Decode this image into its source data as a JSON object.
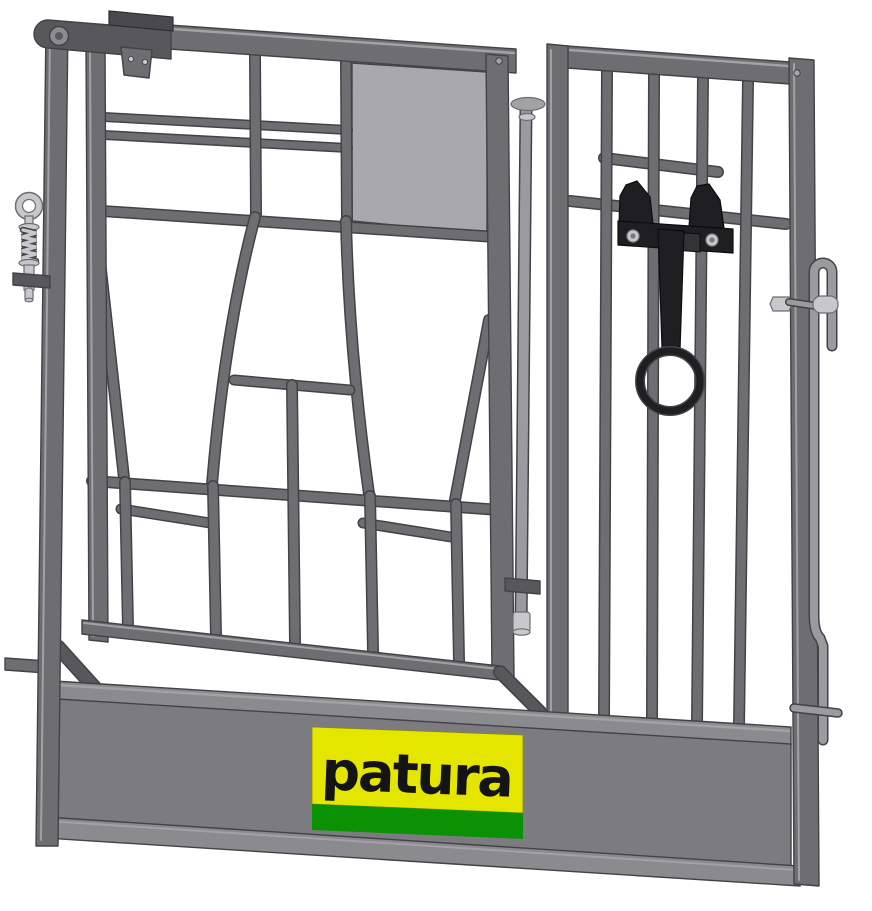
{
  "logo": {
    "text": "patura",
    "panel_bg": "#e5e600",
    "stripe": "#0a9104",
    "text_color": "#141414"
  },
  "colors": {
    "bg": "#ffffff",
    "steel": "#6e6e72",
    "steel_edge": "#434347",
    "steel_light": "#a2a2a6",
    "steel_dark": "#58585c",
    "sheet": "#a9a9ac",
    "trough": "#7c7c80",
    "trough_rail": "#8b8b8f",
    "black_part": "#1f1f22",
    "black_edge": "#0c0c0e",
    "silver": "#c7c7cc",
    "silver_mid": "#9a9aa0",
    "silver_edge": "#6c6c72"
  }
}
